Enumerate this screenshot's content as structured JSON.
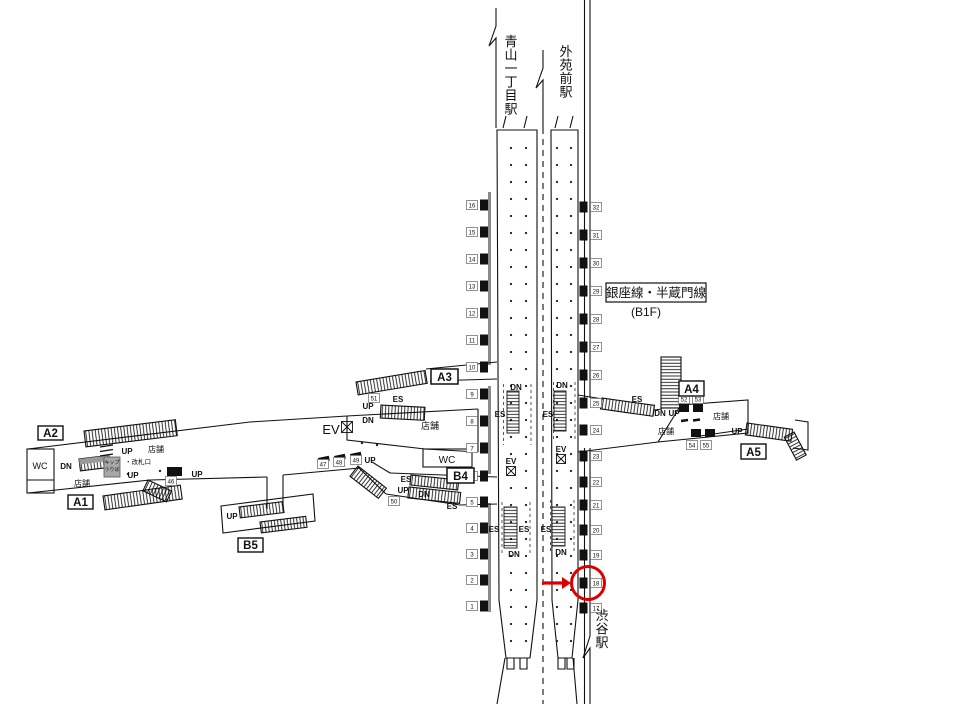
{
  "stations": {
    "aoyama_itchome": "青山一丁目駅",
    "gaienmae": "外苑前駅",
    "shibuya": "渋谷駅"
  },
  "line_info": {
    "name": "銀座線・半蔵門線",
    "floor": "(B1F)"
  },
  "exits": {
    "a1": "A1",
    "a2": "A2",
    "a3": "A3",
    "a4": "A4",
    "a5": "A5",
    "b4": "B4",
    "b5": "B5"
  },
  "facility_labels": {
    "up": "UP",
    "dn": "DN",
    "es": "ES",
    "ev": "EV",
    "wc": "WC",
    "shop": "店舗",
    "ticket_gate": "・改札口",
    "ticket_office_line1": "キップ",
    "ticket_office_line2": "うりば"
  },
  "ad_positions": {
    "left_wall": [
      "16",
      "15",
      "14",
      "13",
      "12",
      "11",
      "10",
      "9",
      "8",
      "7",
      "6",
      "5",
      "4",
      "3",
      "2",
      "1"
    ],
    "right_wall": [
      "32",
      "31",
      "30",
      "29",
      "28",
      "27",
      "26",
      "25",
      "24",
      "23",
      "22",
      "21",
      "20",
      "19",
      "18",
      "17"
    ],
    "left_concourse": [
      "47",
      "48",
      "49",
      "50",
      "51",
      "46"
    ],
    "right_concourse": [
      "52",
      "53",
      "54",
      "55"
    ]
  },
  "highlight": {
    "circled_position": "18",
    "color": "#dd0000"
  }
}
